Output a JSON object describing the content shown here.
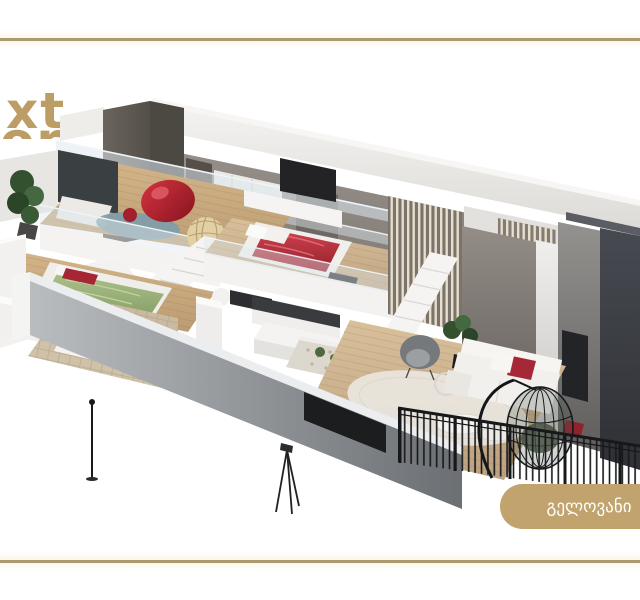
{
  "brand": {
    "logo_line1": "xt",
    "logo_line2": "or"
  },
  "cta": {
    "label": "გელოვანი"
  },
  "illustration": {
    "type": "3d-apartment-cutaway-render",
    "levels_visible": 2
  },
  "colors": {
    "gold_rule": "#ab9a70",
    "logo_gold": "#bd9d66",
    "cta_background": "#c1a36d",
    "cta_text": "#ffffff",
    "charcoal_wall": "#43464d",
    "interior_gray_wall": "#8d8781",
    "front_parapet": "#9a9da1",
    "wood_floor": "#c9a87e",
    "duvet_red": "#c23140",
    "duvet_green": "#9eb37c",
    "beanbag_red": "#b5202c",
    "slat_cream": "#e7dfcc",
    "railing_black": "#17181a",
    "glass_tint": "#dfe8ee"
  }
}
